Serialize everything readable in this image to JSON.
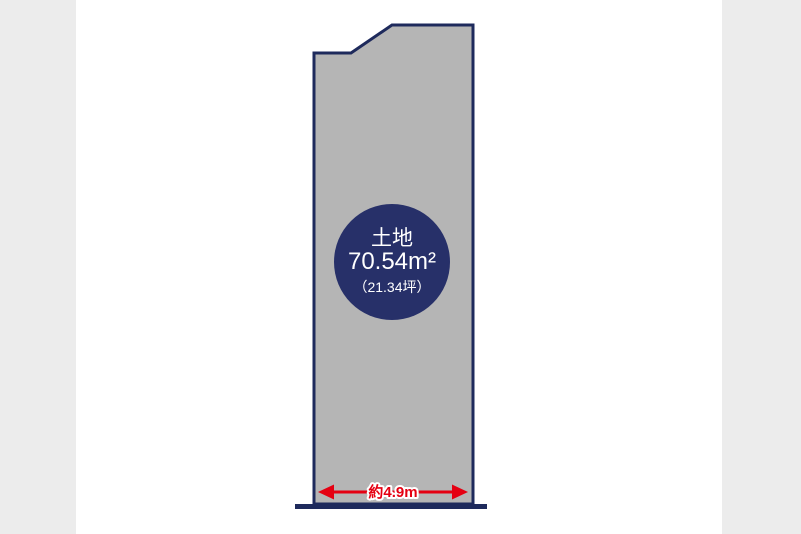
{
  "badge": {
    "label": "土地",
    "area": "70.54m²",
    "tsubo": "（21.34坪）"
  },
  "frontage": {
    "label": "約4.9m"
  },
  "colors": {
    "plot_fill": "#b5b5b5",
    "outline_navy": "#1e2a5c",
    "badge_navy": "#273069",
    "arrow_red": "#e50012",
    "gutter_gray": "#ececec",
    "canvas_white": "#ffffff"
  }
}
